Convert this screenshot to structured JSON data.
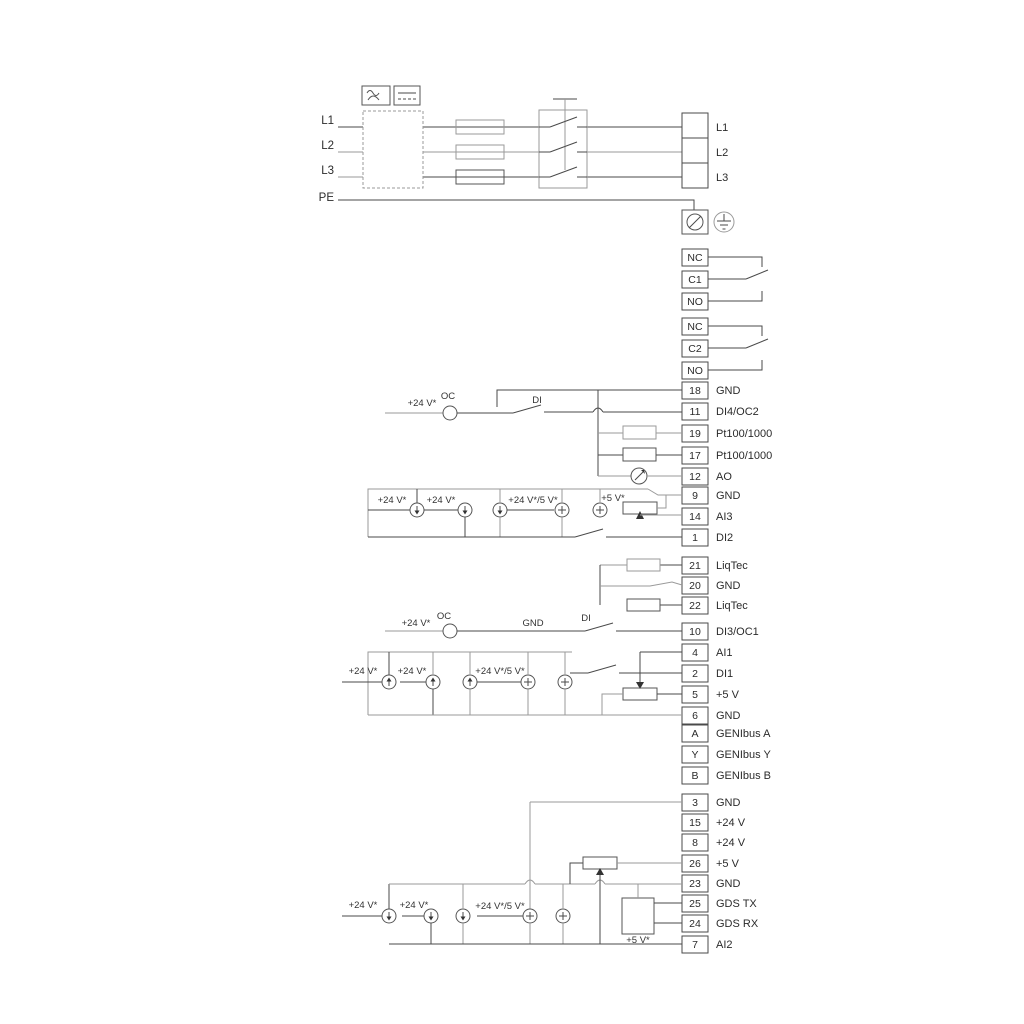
{
  "power": {
    "in": [
      "L1",
      "L2",
      "L3"
    ],
    "pe": "PE",
    "out": [
      "L1",
      "L2",
      "L3"
    ]
  },
  "relays": {
    "r1": [
      "NC",
      "C1",
      "NO"
    ],
    "r2": [
      "NC",
      "C2",
      "NO"
    ]
  },
  "blocks": {
    "b1": [
      {
        "n": "18",
        "l": "GND"
      },
      {
        "n": "11",
        "l": "DI4/OC2"
      },
      {
        "n": "19",
        "l": "Pt100/1000"
      },
      {
        "n": "17",
        "l": "Pt100/1000"
      },
      {
        "n": "12",
        "l": "AO"
      },
      {
        "n": "9",
        "l": "GND"
      },
      {
        "n": "14",
        "l": "AI3"
      },
      {
        "n": "1",
        "l": "DI2"
      }
    ],
    "liq": [
      {
        "n": "21",
        "l": "LiqTec"
      },
      {
        "n": "20",
        "l": "GND"
      },
      {
        "n": "22",
        "l": "LiqTec"
      }
    ],
    "b2": [
      {
        "n": "10",
        "l": "DI3/OC1"
      },
      {
        "n": "4",
        "l": "AI1"
      },
      {
        "n": "2",
        "l": "DI1"
      },
      {
        "n": "5",
        "l": "+5 V"
      },
      {
        "n": "6",
        "l": "GND"
      },
      {
        "n": "A",
        "l": "GENIbus A"
      },
      {
        "n": "Y",
        "l": "GENIbus Y"
      },
      {
        "n": "B",
        "l": "GENIbus B"
      }
    ],
    "b3": [
      {
        "n": "3",
        "l": "GND"
      },
      {
        "n": "15",
        "l": "+24 V"
      },
      {
        "n": "8",
        "l": "+24 V"
      },
      {
        "n": "26",
        "l": "+5 V"
      },
      {
        "n": "23",
        "l": "GND"
      },
      {
        "n": "25",
        "l": "GDS TX"
      },
      {
        "n": "24",
        "l": "GDS RX"
      },
      {
        "n": "7",
        "l": "AI2"
      }
    ]
  },
  "ann": {
    "v24": "+24 V*",
    "v24v5": "+24 V*/5 V*",
    "v5": "+5 V*",
    "oc": "OC",
    "di": "DI",
    "gnd": "GND"
  },
  "colors": {
    "wire_dark": "#4a4a4a",
    "wire_gray": "#9a9a9a",
    "background": "#ffffff"
  }
}
